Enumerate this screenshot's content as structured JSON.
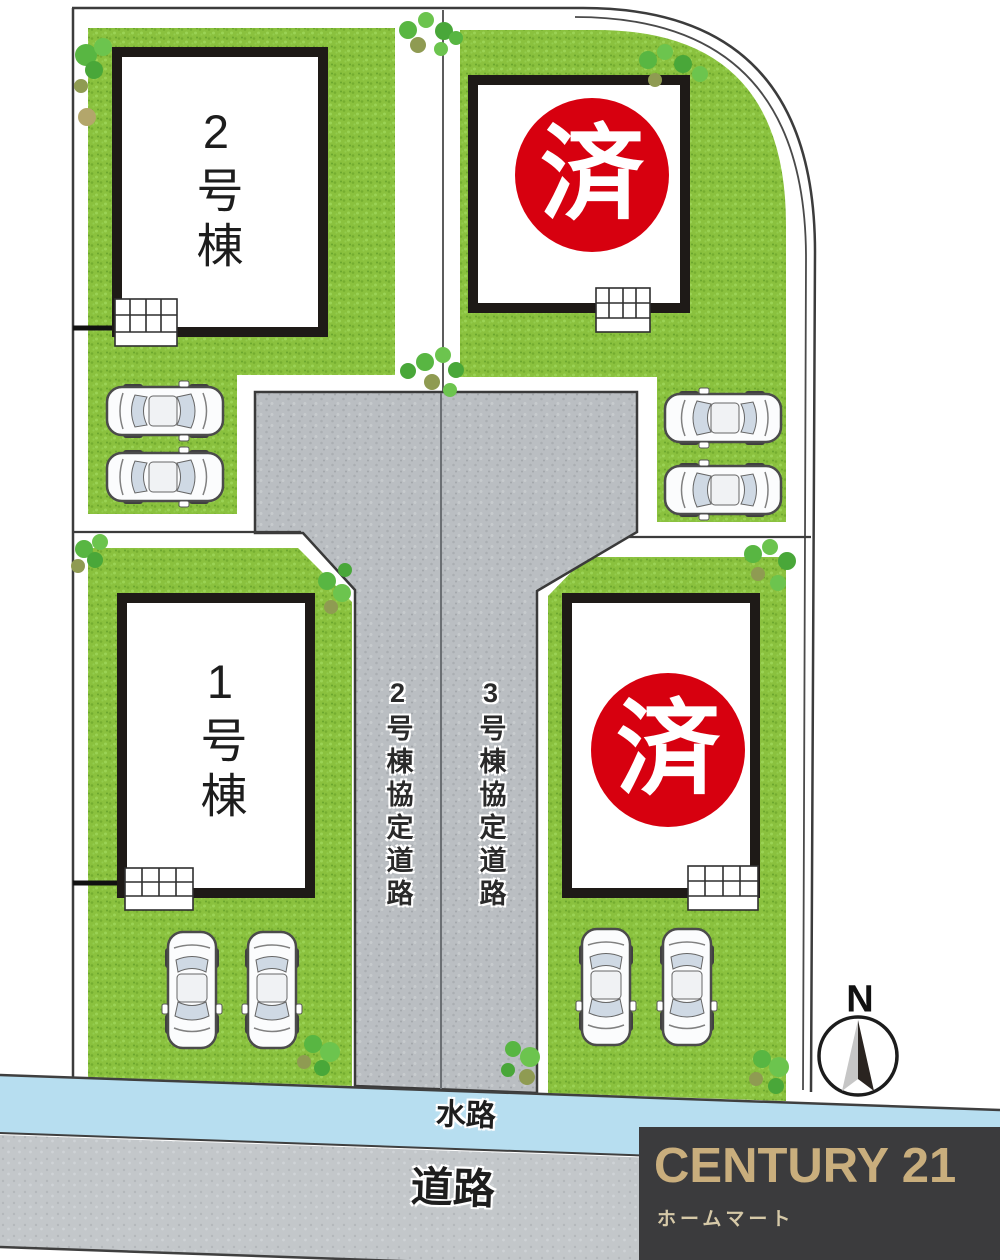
{
  "labels": {
    "building_2": "2号棟",
    "building_1": "1号棟",
    "sold_badge": "済",
    "road_lane_2": "2号棟協定道路",
    "road_lane_3": "3号棟協定道路",
    "waterway": "水路",
    "road": "道路",
    "compass_north": "N"
  },
  "branding": {
    "brand": "CENTURY 21",
    "store_name": "ホームマート"
  },
  "colors": {
    "grass": "#8ac13e",
    "road_fill": "#babec2",
    "water": "#b7def0",
    "sold_red": "#d7000f",
    "boundary_line": "#3c3c3c",
    "brand_gold": "#c9ae7d",
    "logo_bg": "#3b3b3d",
    "store_text": "#d6c9a8"
  }
}
